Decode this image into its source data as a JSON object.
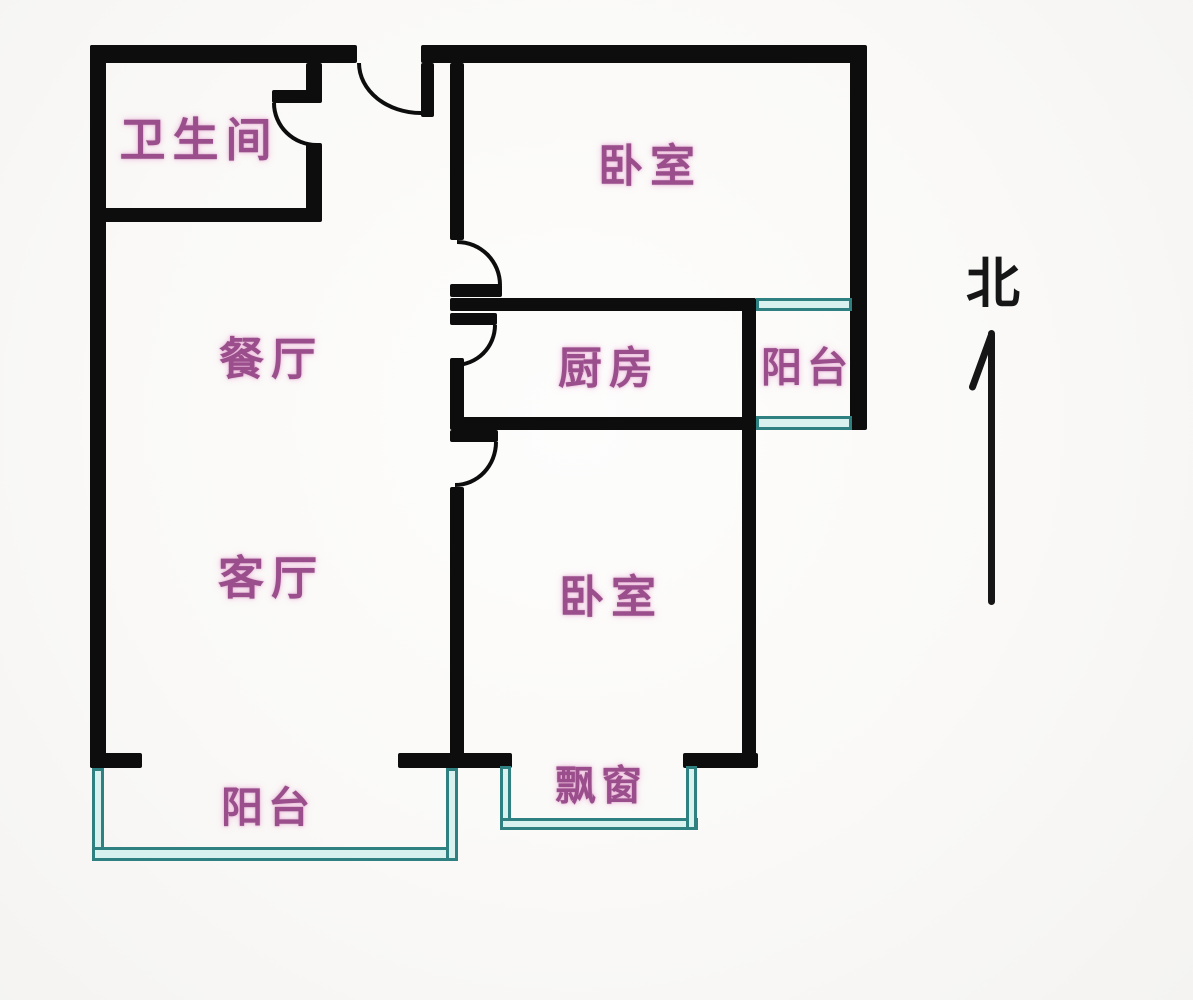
{
  "floorplan": {
    "rooms": [
      {
        "id": "bathroom",
        "label": "卫生间"
      },
      {
        "id": "bedroom-north",
        "label": "卧室"
      },
      {
        "id": "dining-room",
        "label": "餐厅"
      },
      {
        "id": "kitchen",
        "label": "厨房"
      },
      {
        "id": "balcony-east",
        "label": "阳台"
      },
      {
        "id": "living-room",
        "label": "客厅"
      },
      {
        "id": "bedroom-south",
        "label": "卧室"
      },
      {
        "id": "balcony-south",
        "label": "阳台"
      },
      {
        "id": "bay-window",
        "label": "飘窗"
      }
    ],
    "compass": {
      "label": "北"
    },
    "colors": {
      "wall": "#0d0d0d",
      "window_frame": "#2e8081",
      "window_fill": "#d9f2f0",
      "room_label": "#9a4f8c",
      "compass_label": "#161616",
      "background": "#fbfaf8"
    }
  }
}
